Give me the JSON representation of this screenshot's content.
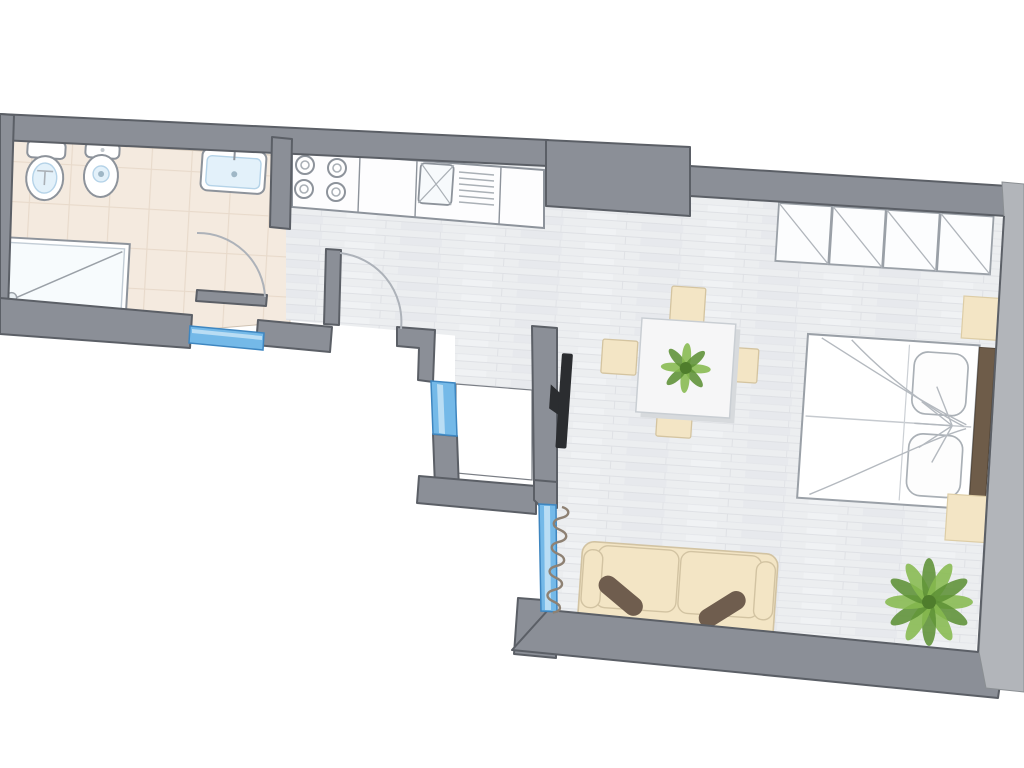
{
  "title": "apartment-floor-plan",
  "colors": {
    "bg": "#ffffff",
    "wall": "#8b8f97",
    "wall_outline": "#5b5f66",
    "wall_light": "#b2b5ba",
    "floor_wood": "#eceef0",
    "plank_line": "#dddfe3",
    "floor_tile": "#f4eadf",
    "tile_line": "#e8dacb",
    "window_fill": "#74b9e8",
    "window_stroke": "#3e86c0",
    "window_light": "#b9ddf4",
    "fixture_stroke": "#8d939b",
    "fixture_light": "#e3f1fa",
    "counter_white": "#fdfdfe",
    "beige": "#f3e5c5",
    "beige_stroke": "#d4c4a0",
    "cushion": "#6f5d4e",
    "headboard": "#6e5c49",
    "sketch": "#b4b9bf",
    "arc": "#adb2b9",
    "table_white": "#f6f6f7",
    "shadow": "#d7dadd",
    "plant": "#86ba4f",
    "plant_dark": "#5d9136",
    "plant_center": "#4f7d2c",
    "tv": "#2b2d30",
    "radiator": "#8e8173"
  },
  "plan": {
    "type": "apartment-floor-plan",
    "rotation_deg": 4,
    "rooms": [
      {
        "id": "bathroom",
        "floor": "beige-tile",
        "fixtures": [
          "toilet",
          "bidet",
          "washbasin",
          "shower-tray"
        ],
        "windows": [
          "window-bottom-left"
        ],
        "doors": [
          "bathroom-door"
        ]
      },
      {
        "id": "kitchen-hall",
        "floor": "light-wood-plank",
        "fixtures": [
          "kitchen-counter",
          "stove-4-burners",
          "kitchen-sink-with-drainer"
        ],
        "doors": [
          "entry-door"
        ]
      },
      {
        "id": "light-shaft",
        "floor": "none-exterior-void",
        "windows": [
          "window-shaft"
        ]
      },
      {
        "id": "living-bedroom",
        "floor": "light-wood-plank",
        "furniture": [
          "wardrobe-4-panels",
          "double-bed",
          "nightstand-top",
          "nightstand-bottom",
          "dining-table",
          "chair-top",
          "chair-left",
          "chair-right",
          "chair-bottom",
          "sofa-2-seat",
          "wall-tv",
          "radiator",
          "floor-plant"
        ],
        "windows": [
          "window-living"
        ]
      }
    ],
    "windows": [
      {
        "id": "window-bottom-left",
        "orientation": "horizontal"
      },
      {
        "id": "window-shaft",
        "orientation": "vertical"
      },
      {
        "id": "window-living",
        "orientation": "vertical",
        "radiator_beside": true
      }
    ],
    "doors": [
      {
        "id": "bathroom-door",
        "swing": "quarter-arc-into-bathroom"
      },
      {
        "id": "entry-door",
        "swing": "quarter-arc-into-hall",
        "leaf_shown_open": true
      }
    ],
    "furniture_details": {
      "wardrobe_panels": 4,
      "bed_pillows": 2,
      "dining_chairs": 4,
      "sofa_cushions": 2,
      "stove_burners": 4,
      "plants": [
        "table-centerpiece-plant",
        "corner-floor-plant"
      ]
    }
  }
}
